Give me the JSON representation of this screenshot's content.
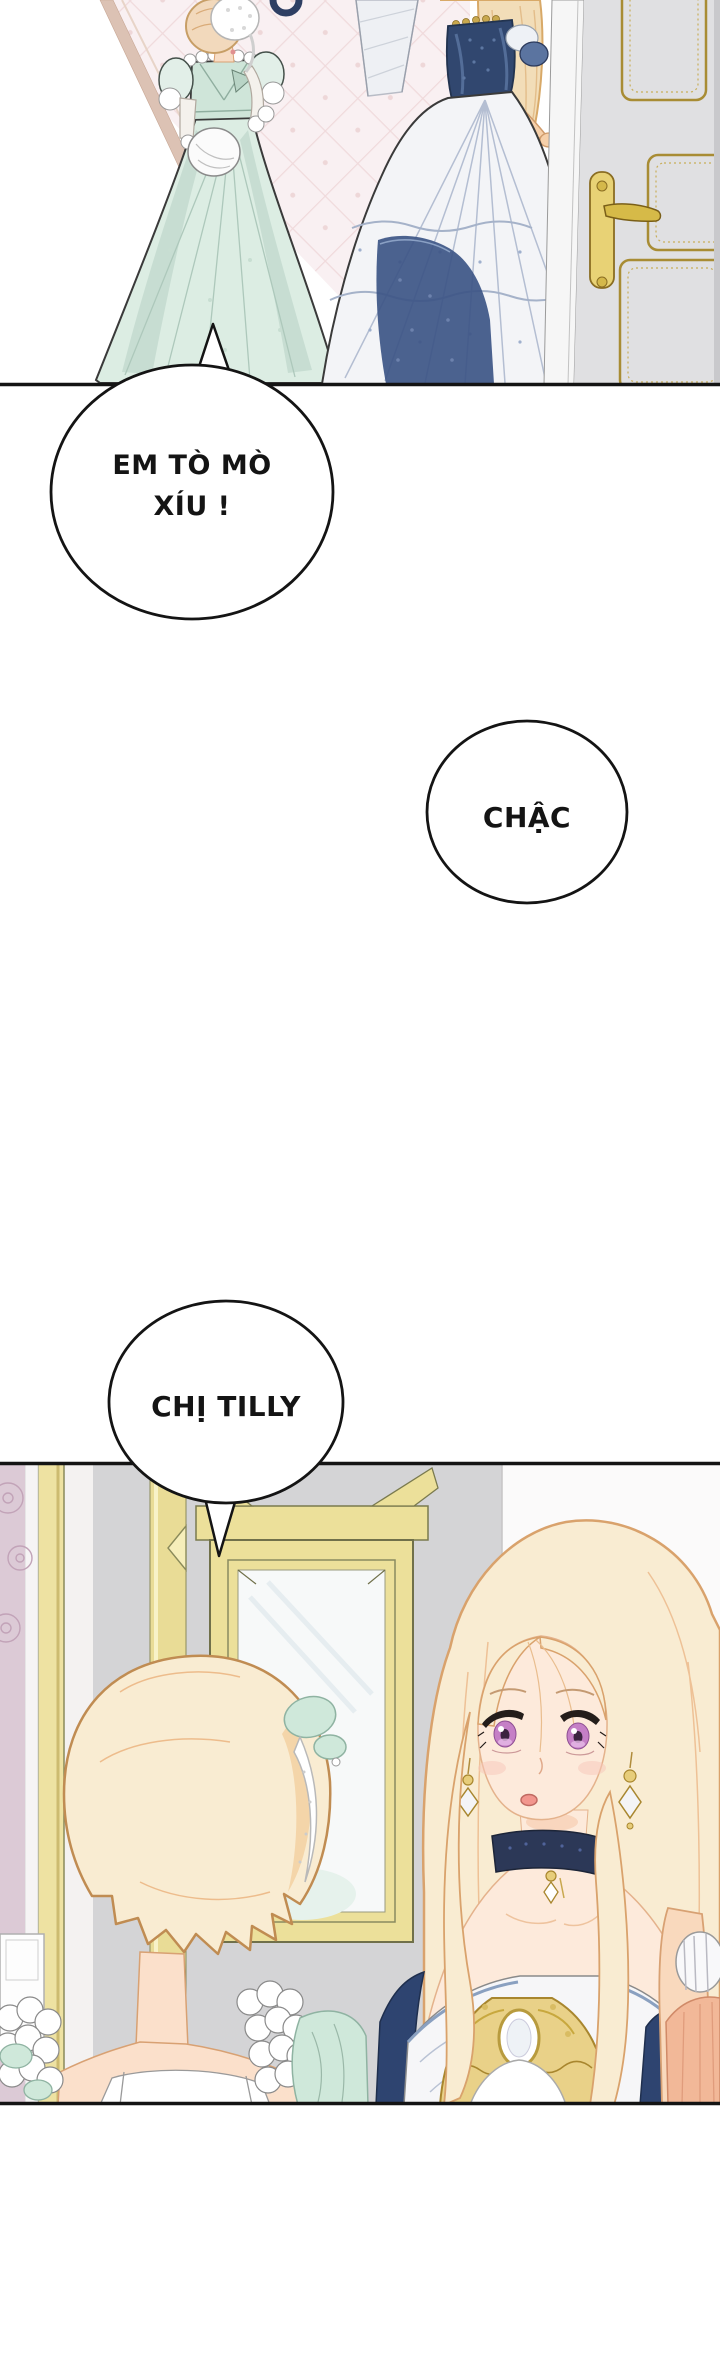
{
  "comic": {
    "bubbles": [
      {
        "name": "bubble-1",
        "lines": [
          "EM TÒ MÒ",
          "XÍU !"
        ]
      },
      {
        "name": "bubble-2",
        "lines": [
          "CHẬC"
        ]
      },
      {
        "name": "bubble-3",
        "lines": [
          "CHỊ TILLY"
        ]
      }
    ],
    "colors": {
      "ink": "#141414",
      "mint_dress": "#dcede3",
      "mint_dark": "#b7d0c4",
      "navy_dress": "#31476f",
      "navy_skirt": "#3d5586",
      "skirt_white": "#f3f4f7",
      "hair_gold": "#f9ecd2",
      "hair_outline": "#d9a26c",
      "skin": "#fdeadb",
      "eye_violet": "#c57fc6",
      "door_gray": "#e0e0e2",
      "door_gold": "#a88c34",
      "wall_gray": "#d4d4d6",
      "wall_pink": "#dccad6",
      "wall_white": "#fbfafa",
      "frame_gold": "#ece09a",
      "choker_navy": "#2c3857",
      "brooch_gold": "#e9d188",
      "salmon_sleeve": "#f2b898"
    }
  }
}
